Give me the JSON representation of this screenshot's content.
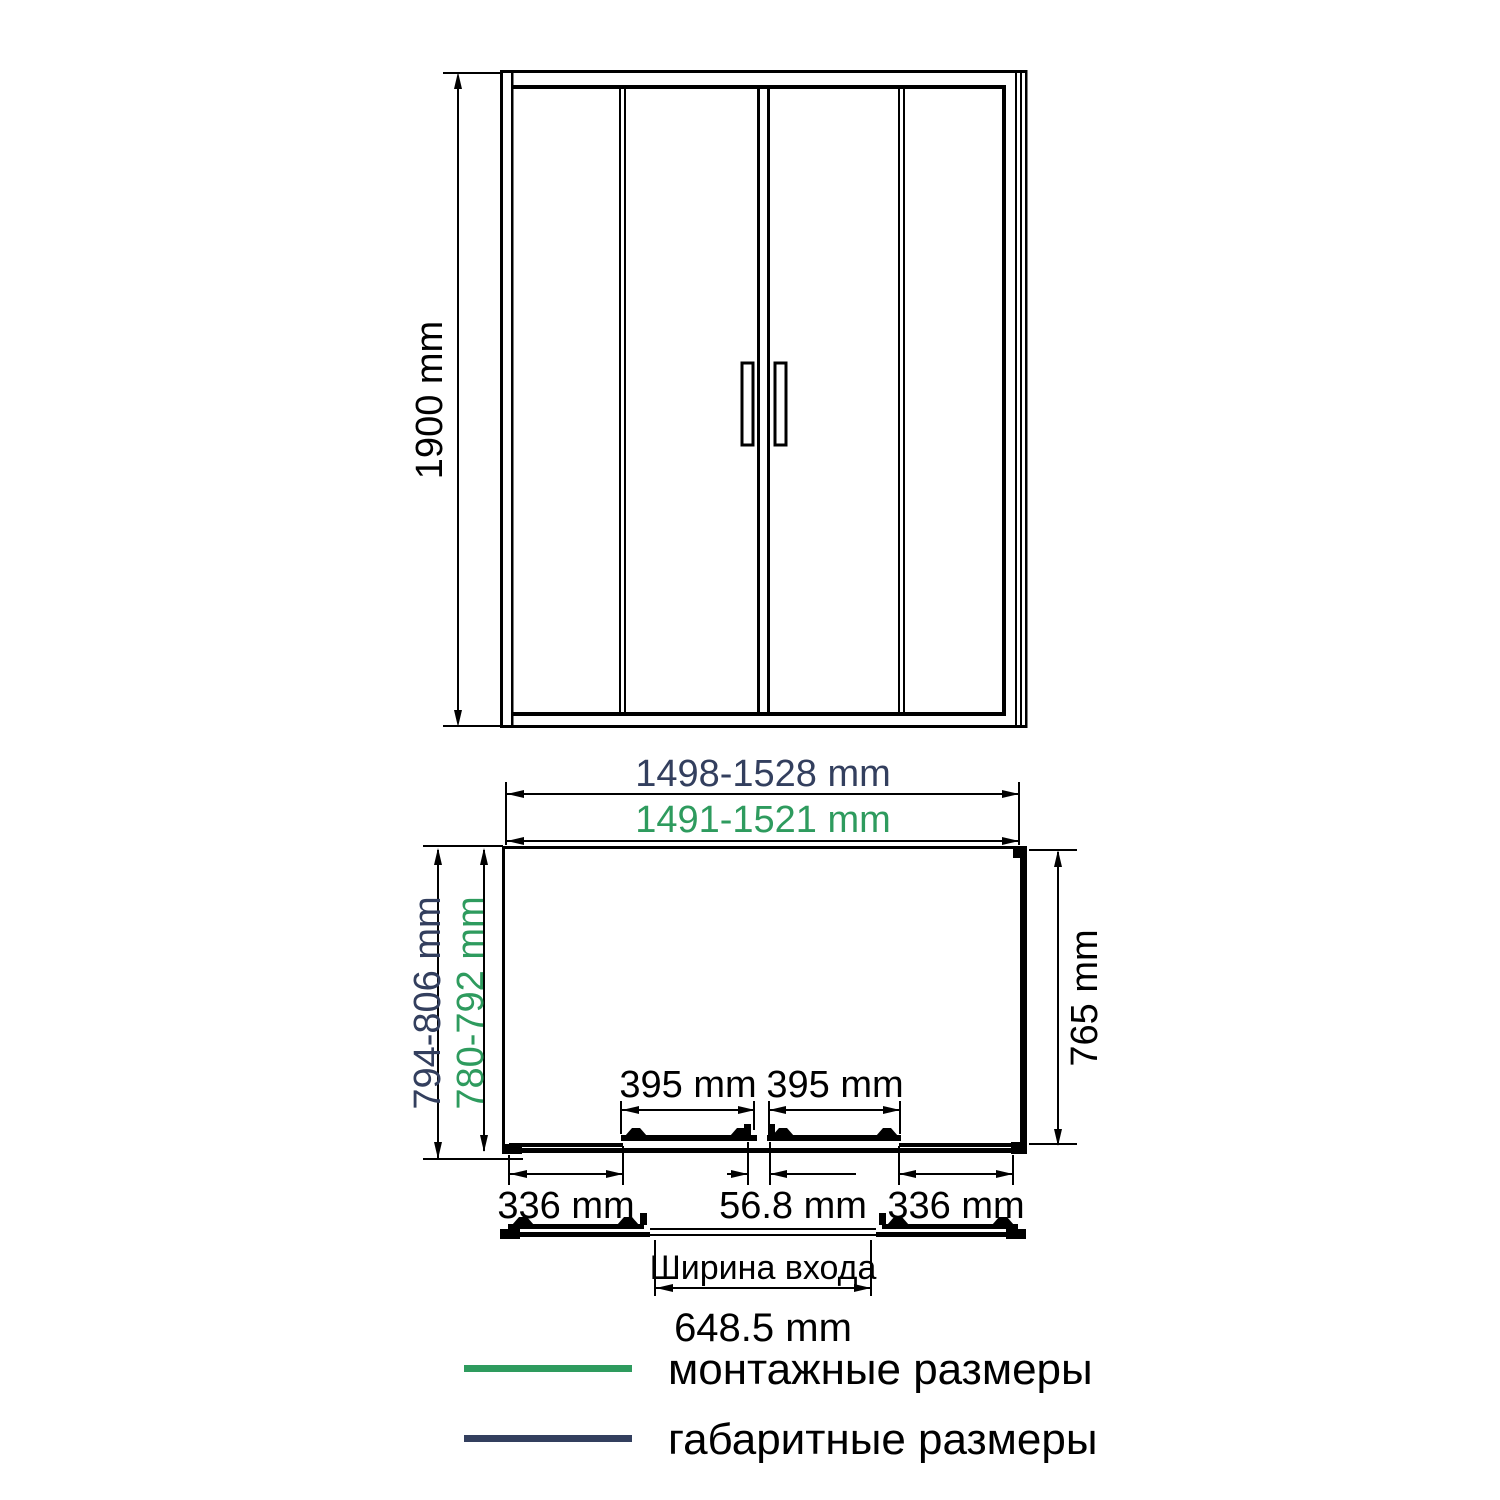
{
  "front_view": {
    "height": "1900 mm"
  },
  "plan_view": {
    "overall_width": "1498-1528 mm",
    "mounting_width": "1491-1521 mm",
    "overall_depth": "794-806 mm",
    "mounting_depth": "780-792 mm",
    "inner_depth": "765 mm",
    "door_panel_left": "395 mm",
    "door_panel_right": "395 mm",
    "fixed_panel_left": "336 mm",
    "center_overlap": "56.8 mm",
    "fixed_panel_right": "336 mm"
  },
  "entrance": {
    "label": "Ширина входа",
    "width": "648.5 mm"
  },
  "legend": {
    "mounting_label": "монтажные размеры",
    "overall_label": "габаритные размеры"
  },
  "colors": {
    "mounting_green": "#2E9B5E",
    "overall_navy": "#333F5E",
    "line": "#000000"
  }
}
